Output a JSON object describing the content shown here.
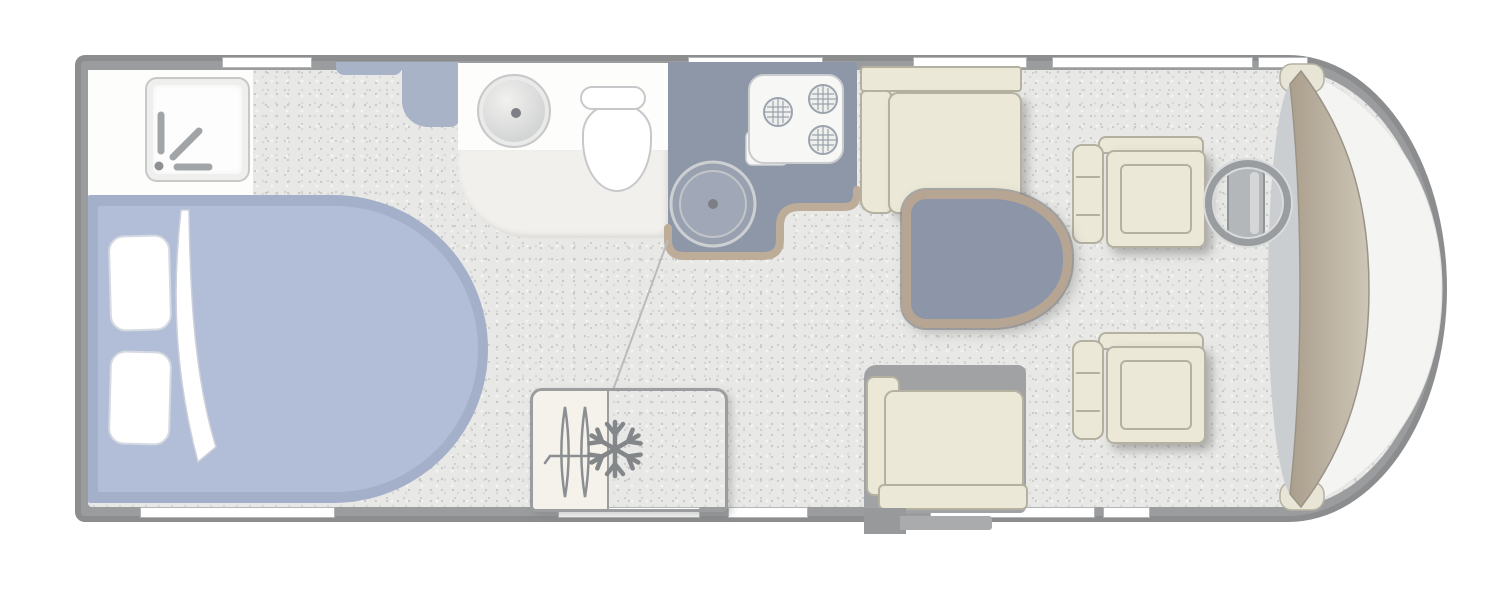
{
  "meta": {
    "description": "Motorhome floor plan, top-down schematic drawing, no text labels"
  },
  "colors": {
    "page_bg": "#ffffff",
    "outline": "#8b8d8f",
    "wall": "#9a9c9e",
    "window_white": "#ffffff",
    "floor_base": "#e8e8e6",
    "speckle_dark": "#c9c9c7",
    "speckle_mid": "#d8d8d6",
    "bed_frame": "#a4afca",
    "bed_mattress": "#b2bed7",
    "linen_white": "#ffffff",
    "linen_edge": "#d5d9e2",
    "cabinet_blue": "#a9b3c8",
    "washroom_white": "#fdfdfc",
    "washroom_floor": "#f2f0ec",
    "fixture_line": "#c6c8ca",
    "counter_dark": "#8e97a8",
    "counter_trim": "#bdac98",
    "hob_white": "#f7f7f5",
    "burner_line": "#9ba3ad",
    "sink_fill": "#99a1b1",
    "dot_gray": "#7c7f83",
    "cream": "#ebe8d8",
    "cream_line": "#b4b1a1",
    "seatbase_gray": "#a0a2a4",
    "table_top": "#8c96a8",
    "table_trim": "#b7a593",
    "dash_light": "#cdc6b6",
    "dash_dark": "#ab9f8d",
    "windscreen": "#f4f4f2",
    "cab_floor": "#cbced1",
    "icon_gray": "#84878a",
    "step_dark": "#97999b",
    "step_light": "#a9abad"
  },
  "fixtures": {
    "shower_room": {
      "label": "Shower room"
    },
    "shower_tray": {
      "label": "Shower tray"
    },
    "shower_head_icon": {
      "label": "Shower head symbol"
    },
    "island_bed": {
      "label": "Island bed"
    },
    "pillow": {
      "label": "Pillow"
    },
    "duvet": {
      "label": "Turned-back duvet"
    },
    "wardrobe": {
      "label": "Wardrobe unit"
    },
    "washroom": {
      "label": "Washroom"
    },
    "washbasin": {
      "label": "Washbasin"
    },
    "toilet": {
      "label": "Toilet"
    },
    "kitchen_worktop": {
      "label": "Kitchen worktop"
    },
    "hob": {
      "label": "Three-burner hob"
    },
    "kitchen_sink": {
      "label": "Kitchen sink"
    },
    "dinette_bench": {
      "label": "Dinette bench seat"
    },
    "dinette_table": {
      "label": "Dinette table"
    },
    "travel_seat": {
      "label": "Forward-facing travel seat"
    },
    "fridge": {
      "label": "Fridge"
    },
    "snowflake_icon": {
      "label": "Snowflake symbol (fridge)"
    },
    "heater_icon": {
      "label": "Heater symbol"
    },
    "entry_step": {
      "label": "Entry step"
    },
    "driver_seat": {
      "label": "Driver cab seat"
    },
    "passenger_seat": {
      "label": "Passenger cab seat"
    },
    "steering_wheel": {
      "label": "Steering wheel"
    },
    "dashboard": {
      "label": "Dashboard"
    },
    "windscreen": {
      "label": "Windscreen"
    },
    "window": {
      "label": "Window"
    },
    "door": {
      "label": "Entrance door"
    }
  }
}
